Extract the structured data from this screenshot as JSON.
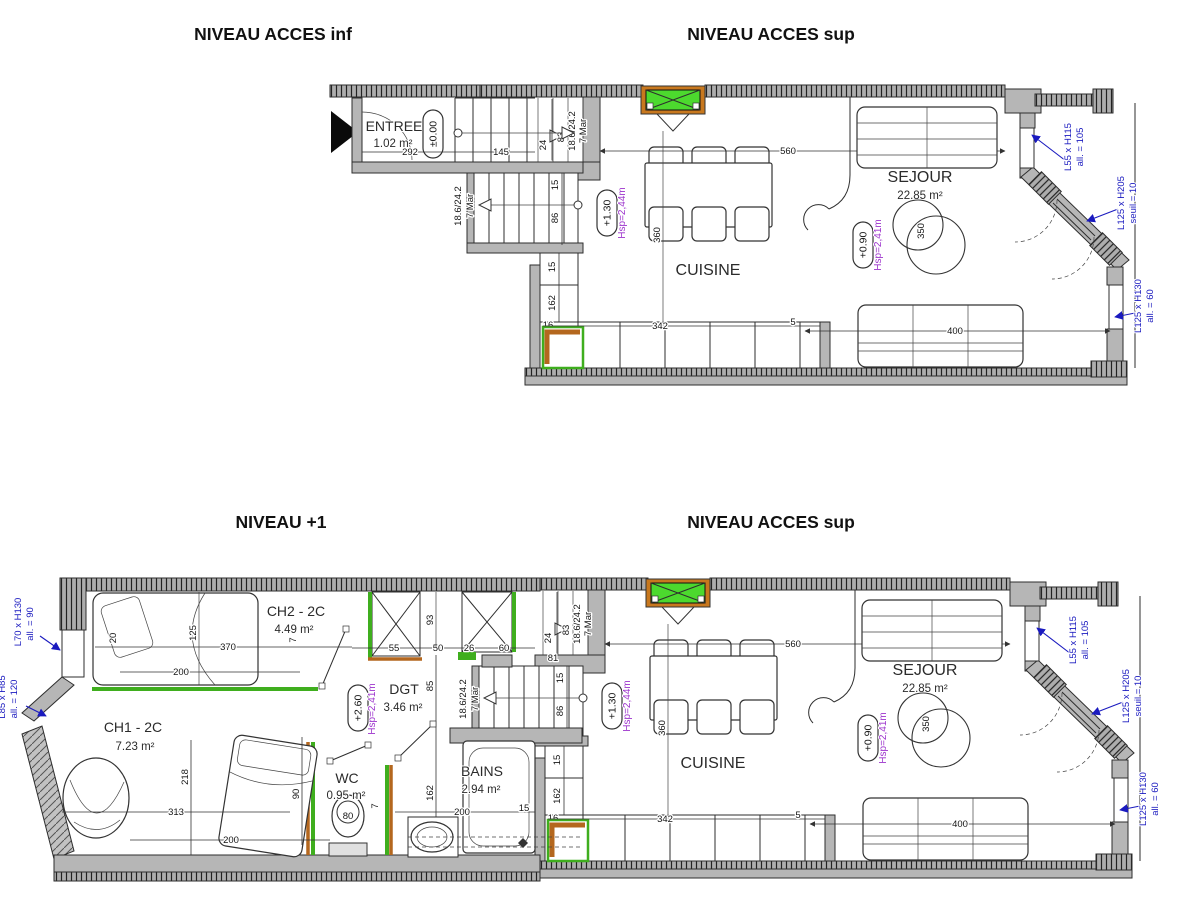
{
  "titles": {
    "top_left": "NIVEAU ACCES inf",
    "top_right": "NIVEAU ACCES sup",
    "bottom_left": "NIVEAU +1",
    "bottom_right": "NIVEAU ACCES sup"
  },
  "colors": {
    "wall_gray": "#b6b6b6",
    "partition_green": "#3fae1e",
    "threshold_orange": "#b4671e",
    "skylight_green": "#4cd92e",
    "annotation_blue": "#1a1abf",
    "height_purple": "#9c33cc"
  },
  "entree_plan": {
    "room": "ENTREE",
    "area": "1.02 m²",
    "elevation": "±0.00",
    "dims": {
      "d292": "292",
      "d145": "145"
    }
  },
  "sup_plan": {
    "cuisine": "CUISINE",
    "sejour": "SEJOUR",
    "sejour_area": "22.85 m²",
    "elev_kitchen": "+1.30",
    "hsp_kitchen": "Hsp=2,44m",
    "elev_sejour": "+0.90",
    "hsp_sejour": "Hsp=2,41m",
    "stair_ratio": "18.6/24.2",
    "stair_mar": "7 Mar",
    "dims": {
      "d560": "560",
      "d360": "360",
      "d350": "350",
      "d400": "400",
      "d342": "342",
      "d5": "5",
      "d15a": "15",
      "d162": "162",
      "d16": "16",
      "d81": "81",
      "d24": "24",
      "d83": "83",
      "d15b": "15",
      "d86": "86"
    },
    "windows": [
      {
        "size": "L55 x H115",
        "sill": "all. = 105"
      },
      {
        "size": "L125 x H205",
        "sill": "seuil = 10"
      },
      {
        "size": "L125 x H130",
        "sill": "all. = 60"
      }
    ]
  },
  "n1_plan": {
    "ch2": "CH2 - 2C",
    "ch2_area": "4.49 m²",
    "ch1": "CH1 - 2C",
    "ch1_area": "7.23 m²",
    "dgt": "DGT",
    "dgt_area": "3.46 m²",
    "wc": "WC",
    "wc_area": "0.95 m²",
    "wc_seat": "80",
    "bains": "BAINS",
    "bains_area": "2.94 m²",
    "elev": "+2.60",
    "hsp": "Hsp=2,41m",
    "dims": {
      "d370": "370",
      "d200a": "200",
      "d125": "125",
      "d20": "20",
      "d7a": "7",
      "d55": "55",
      "d50": "50",
      "d26": "26",
      "d60": "60",
      "d93": "93",
      "d85": "85",
      "d162": "162",
      "d200b": "200",
      "d15": "15",
      "d218": "218",
      "d313": "313",
      "d200c": "200",
      "d90": "90",
      "d7b": "7"
    },
    "windows": [
      {
        "size": "L70 x H130",
        "sill": "all. = 90"
      },
      {
        "size": "L85 x H85",
        "sill": "all. = 120"
      }
    ]
  }
}
